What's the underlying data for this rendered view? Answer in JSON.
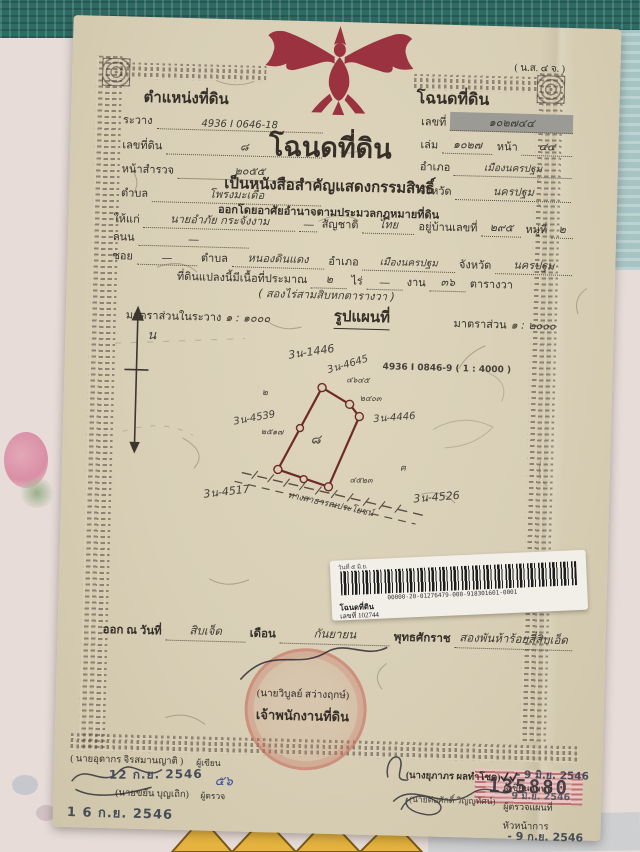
{
  "colors": {
    "paper": "#d8cfb6",
    "garuda_red": "#9a3240",
    "stamp_red": "#c1645a",
    "annotation_red": "#b8352e",
    "teal_fabric": "#2e6b65",
    "serial_pink": "#e9c6c3"
  },
  "doc": {
    "form_code": "( น.ส. ๔ จ. )",
    "pos_box": {
      "title": "ตำแหน่งที่ดิน",
      "fields": [
        {
          "label": "ระวาง",
          "value": "4936 I 0646-18"
        },
        {
          "label": "เลขที่ดิน",
          "value": "๘"
        },
        {
          "label": "หน้าสำรวจ",
          "value": "๒๐๕๕"
        },
        {
          "label": "ตำบล",
          "value": "โพรงมะเดื่อ"
        }
      ]
    },
    "deed_box": {
      "title": "โฉนดที่ดิน",
      "no_label": "เลขที่",
      "no_value": "๑๐๒๗๔๔",
      "book_label": "เล่ม",
      "book_value": "๑๐๒๗",
      "page_label": "หน้า",
      "page_value": "๔๔",
      "amphoe_label": "อำเภอ",
      "amphoe_value": "เมืองนครปฐม",
      "province_label": "จังหวัด",
      "province_value": "นครปฐม"
    },
    "title_block": {
      "main": "โฉนดที่ดิน",
      "sub1": "เป็นหนังสือสำคัญแสดงกรรมสิทธิ์",
      "sub2": "ออกโดยอาศัยอำนาจตามประมวลกฎหมายที่ดิน"
    },
    "grant": {
      "to_label": "ให้แก่",
      "to_value": "นายอำภัย กระจังงาม",
      "dash": "—",
      "nat_label": "สัญชาติ",
      "nat_value": "ไทย",
      "addr_label": "อยู่บ้านเลขที่",
      "addr_value": "๒๙๕",
      "moo_label": "หมู่ที่",
      "moo_value": "๒",
      "road_label": "ถนน",
      "soi_label": "ซอย",
      "tambon_label": "ตำบล",
      "tambon_value": "หนองดินแดง",
      "amphoe_label": "อำเภอ",
      "amphoe_value": "เมืองนครปฐม",
      "province_label": "จังหวัด",
      "province_value": "นครปฐม",
      "area_label": "ที่ดินแปลงนี้มีเนื้อที่ประมาณ",
      "rai_value": "๒",
      "rai_label": "ไร่",
      "ngan_label": "งาน",
      "wa_value": "๓๖",
      "wa_label": "ตารางวา",
      "area_words": "( สองไร่สามสิบหกตารางวา )"
    },
    "scale_row": {
      "left_label": "มาตราส่วนในระวาง",
      "left_value": "๑ : ๑๐๐๐",
      "center": "รูปแผนที่",
      "right_label": "มาตราส่วน",
      "right_value": "๑ : ๒๐๐๐"
    },
    "map": {
      "north": "น",
      "parcel_no": "๘",
      "red_ref": "4936 I 0846-9 ( 1 : 4000 )",
      "labels": [
        "3น-1446",
        "3น-4645",
        "3น-4539",
        "3น-4446",
        "3น-4517",
        "3น-4526"
      ],
      "small_marks": [
        "๔๖๔๕",
        "๒๔๐๓",
        "๔๕๒๓",
        "๒๕๑๗",
        "๒",
        "ฅ"
      ],
      "road_label": "ทางสาธารณประโยชน์"
    },
    "sticker": {
      "top_line": "วันที่ ๕ มิ.ย.",
      "barcode_number": "00000-20-01276479-000-918301601-0001",
      "doc_type": "โฉนดที่ดิน",
      "deed_no": "เลขที่ 102744"
    },
    "issue_line": {
      "prefix": "ออก ณ วันที่",
      "day": "สิบเจ็ด",
      "month_label": "เดือน",
      "month": "กันยายน",
      "era_label": "พุทธศักราช",
      "year": "สองพันห้าร้อยสี่สิบเอ็ด"
    },
    "registrar_stamp": {
      "name": "(นายวิบูลย์ สว่างฤกษ์)",
      "role": "เจ้าพนักงานที่ดิน"
    },
    "officials_left": {
      "writer_name": "( นายอุดากร จิรสมานญาติ )",
      "writer_role": "ผู้เขียน",
      "stamp1": "12 ก.ย. 2546",
      "note": "๕๖",
      "checker_name": "(นายขยัน บุญเถิก)",
      "checker_role": "ผู้ตรวจ",
      "stamp2": "1 6 ก.ย. 2546"
    },
    "serial_box": "135880",
    "officials_right": {
      "map_writer_name": "(นางยุภาภร ผลทำโชค)",
      "map_writer_role": "ผู้เขียนแผนที่",
      "stamp1": "- 9 มิ.ย. 2546",
      "map_checker_name": "(นายต่อศักดิ์ วิญญูทัศน์)",
      "map_checker_role": "ผู้ตรวจแผนที่",
      "stamp2": "9 มิ.ย. 2546",
      "head_role": "หัวหน้าการ",
      "stamp3": "- 9 ก.ย. 2546"
    }
  }
}
